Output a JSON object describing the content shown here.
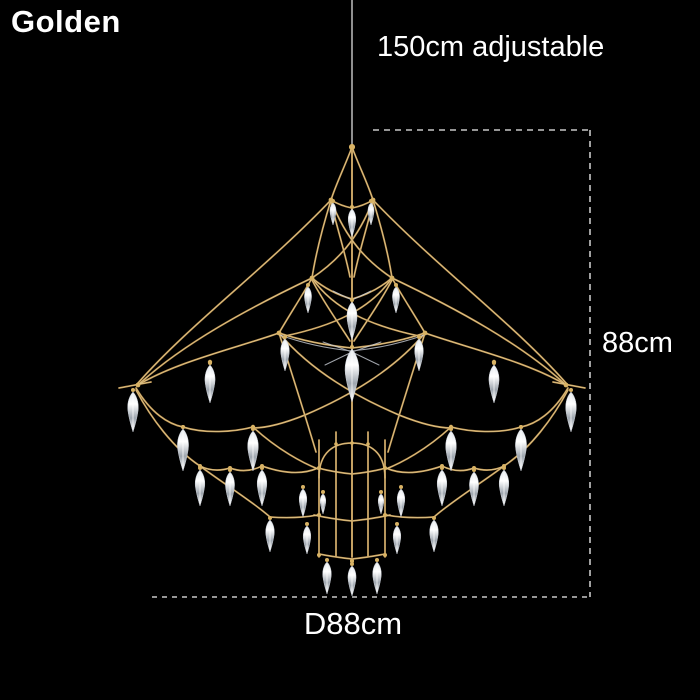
{
  "labels": {
    "variant": "Golden",
    "adjustable_height": "150cm adjustable",
    "fixture_height": "88cm",
    "diameter": "D88cm"
  },
  "colors": {
    "bg": "#000000",
    "text": "#ffffff",
    "gold": "#bd9250",
    "gold_light": "#ecd9a0",
    "bead": "#d8b264",
    "silver": "#c9ced6",
    "dash": "#c8c8c8",
    "cable": "#8f8f8f",
    "crystal_hi": "#ffffff",
    "crystal_mid": "#dfe4e9",
    "crystal_lo": "#9ea6af"
  },
  "illustration": {
    "name": "gold-wireframe-crystal-chandelier",
    "crystals": [
      [
        352,
        207,
        30
      ],
      [
        333,
        201,
        24
      ],
      [
        371,
        201,
        24
      ],
      [
        352,
        300,
        40
      ],
      [
        308,
        285,
        28
      ],
      [
        396,
        285,
        28
      ],
      [
        352,
        347,
        55
      ],
      [
        285,
        337,
        34
      ],
      [
        419,
        337,
        34
      ],
      [
        210,
        363,
        40
      ],
      [
        494,
        363,
        40
      ],
      [
        133,
        390,
        42
      ],
      [
        571,
        390,
        42
      ],
      [
        183,
        427,
        44
      ],
      [
        521,
        427,
        44
      ],
      [
        253,
        429,
        42
      ],
      [
        451,
        429,
        42
      ],
      [
        200,
        468,
        38
      ],
      [
        504,
        468,
        38
      ],
      [
        230,
        470,
        36
      ],
      [
        474,
        470,
        36
      ],
      [
        262,
        468,
        38
      ],
      [
        442,
        468,
        38
      ],
      [
        303,
        487,
        30
      ],
      [
        401,
        487,
        30
      ],
      [
        323,
        492,
        22
      ],
      [
        381,
        492,
        22
      ],
      [
        270,
        518,
        34
      ],
      [
        434,
        518,
        34
      ],
      [
        307,
        524,
        30
      ],
      [
        397,
        524,
        30
      ],
      [
        327,
        560,
        34
      ],
      [
        352,
        564,
        32
      ],
      [
        377,
        560,
        34
      ]
    ],
    "beads": [
      [
        352,
        147,
        3
      ],
      [
        373,
        200,
        2.4
      ],
      [
        392,
        278,
        2.4
      ],
      [
        425,
        333,
        2.4
      ],
      [
        566,
        385,
        2.4
      ],
      [
        494,
        362,
        2.2
      ],
      [
        451,
        427,
        2.2
      ],
      [
        521,
        427,
        2
      ],
      [
        504,
        466,
        2
      ],
      [
        474,
        468,
        2
      ],
      [
        442,
        466,
        2
      ],
      [
        385,
        468,
        2
      ],
      [
        385,
        515,
        2
      ],
      [
        385,
        555,
        2
      ],
      [
        368,
        444,
        1.8
      ],
      [
        352,
        561,
        2
      ],
      [
        352,
        443,
        1.8
      ]
    ]
  }
}
